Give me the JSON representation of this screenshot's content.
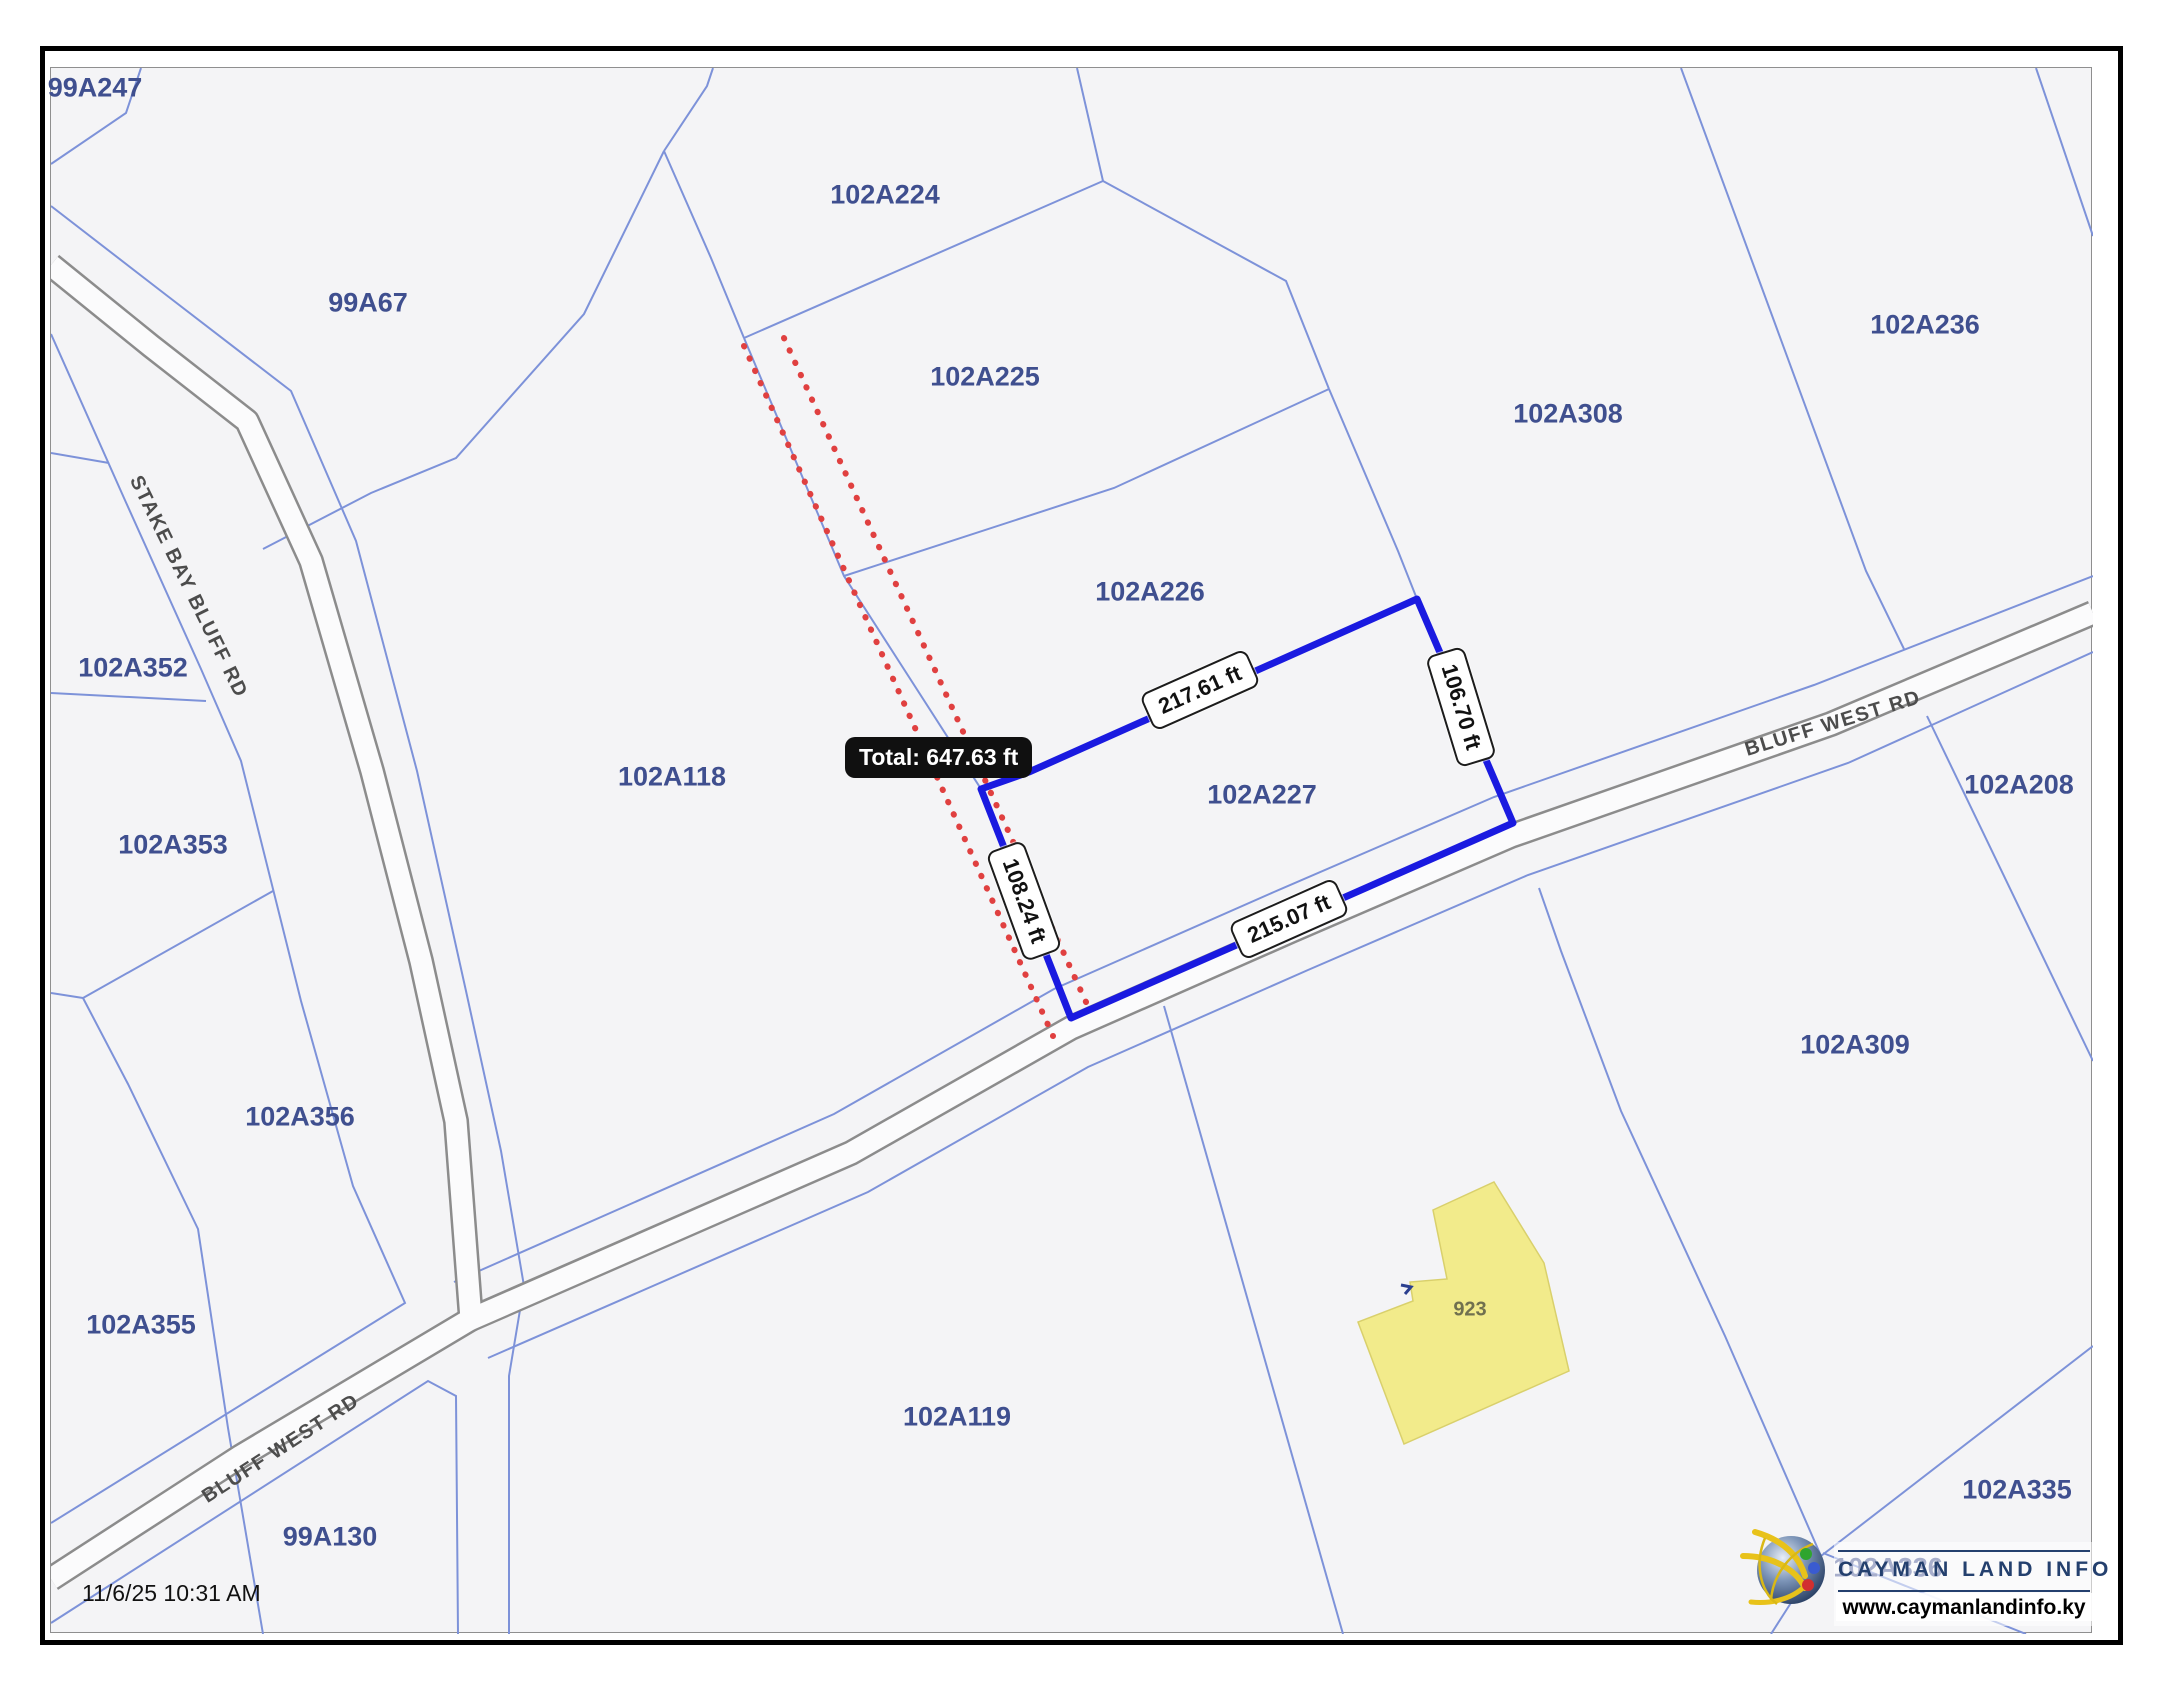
{
  "map": {
    "timestamp": "11/6/25 10:31 AM",
    "parcel_labels": [
      {
        "text": "99A247",
        "x": 95,
        "y": 88
      },
      {
        "text": "102A224",
        "x": 885,
        "y": 195
      },
      {
        "text": "99A67",
        "x": 368,
        "y": 303
      },
      {
        "text": "102A236",
        "x": 1925,
        "y": 325
      },
      {
        "text": "102A225",
        "x": 985,
        "y": 377
      },
      {
        "text": "102A308",
        "x": 1568,
        "y": 414
      },
      {
        "text": "102A226",
        "x": 1150,
        "y": 592
      },
      {
        "text": "102A352",
        "x": 133,
        "y": 668
      },
      {
        "text": "102A118",
        "x": 672,
        "y": 777
      },
      {
        "text": "102A227",
        "x": 1262,
        "y": 795
      },
      {
        "text": "102A208",
        "x": 2019,
        "y": 785
      },
      {
        "text": "102A353",
        "x": 173,
        "y": 845
      },
      {
        "text": "102A309",
        "x": 1855,
        "y": 1045
      },
      {
        "text": "102A356",
        "x": 300,
        "y": 1117
      },
      {
        "text": "102A355",
        "x": 141,
        "y": 1325
      },
      {
        "text": "102A119",
        "x": 957,
        "y": 1417
      },
      {
        "text": "99A130",
        "x": 330,
        "y": 1537
      },
      {
        "text": "102A335",
        "x": 2017,
        "y": 1490
      },
      {
        "text": "102A336",
        "x": 1888,
        "y": 1568
      }
    ],
    "road_labels": [
      {
        "text": "STAKE BAY BLUFF RD",
        "x": 188,
        "y": 587,
        "rot": 64
      },
      {
        "text": "BLUFF WEST RD",
        "x": 1833,
        "y": 724,
        "rot": -17
      },
      {
        "text": "BLUFF WEST RD",
        "x": 281,
        "y": 1449,
        "rot": -33
      }
    ],
    "measure": {
      "total": "Total: 647.63 ft",
      "segments": [
        {
          "text": "217.61 ft",
          "x": 1200,
          "y": 690,
          "rot": -24
        },
        {
          "text": "106.70 ft",
          "x": 1461,
          "y": 707,
          "rot": 73
        },
        {
          "text": "108.24 ft",
          "x": 1024,
          "y": 901,
          "rot": 70
        },
        {
          "text": "215.07 ft",
          "x": 1289,
          "y": 919,
          "rot": -24
        }
      ]
    },
    "building": {
      "label": "923",
      "x": 1470,
      "y": 1310
    },
    "colors": {
      "parcel_line": "#7d92d9",
      "measure_polygon": "#1a1ae0",
      "guide_red": "#e04040",
      "building_fill": "#f2eb8b",
      "building_stroke": "#d9d06c",
      "label_blue": "#3f4f8f",
      "road_gray": "#8c8c8c"
    }
  },
  "branding": {
    "title": "CAYMAN LAND INFO",
    "url": "www.caymanlandinfo.ky"
  }
}
